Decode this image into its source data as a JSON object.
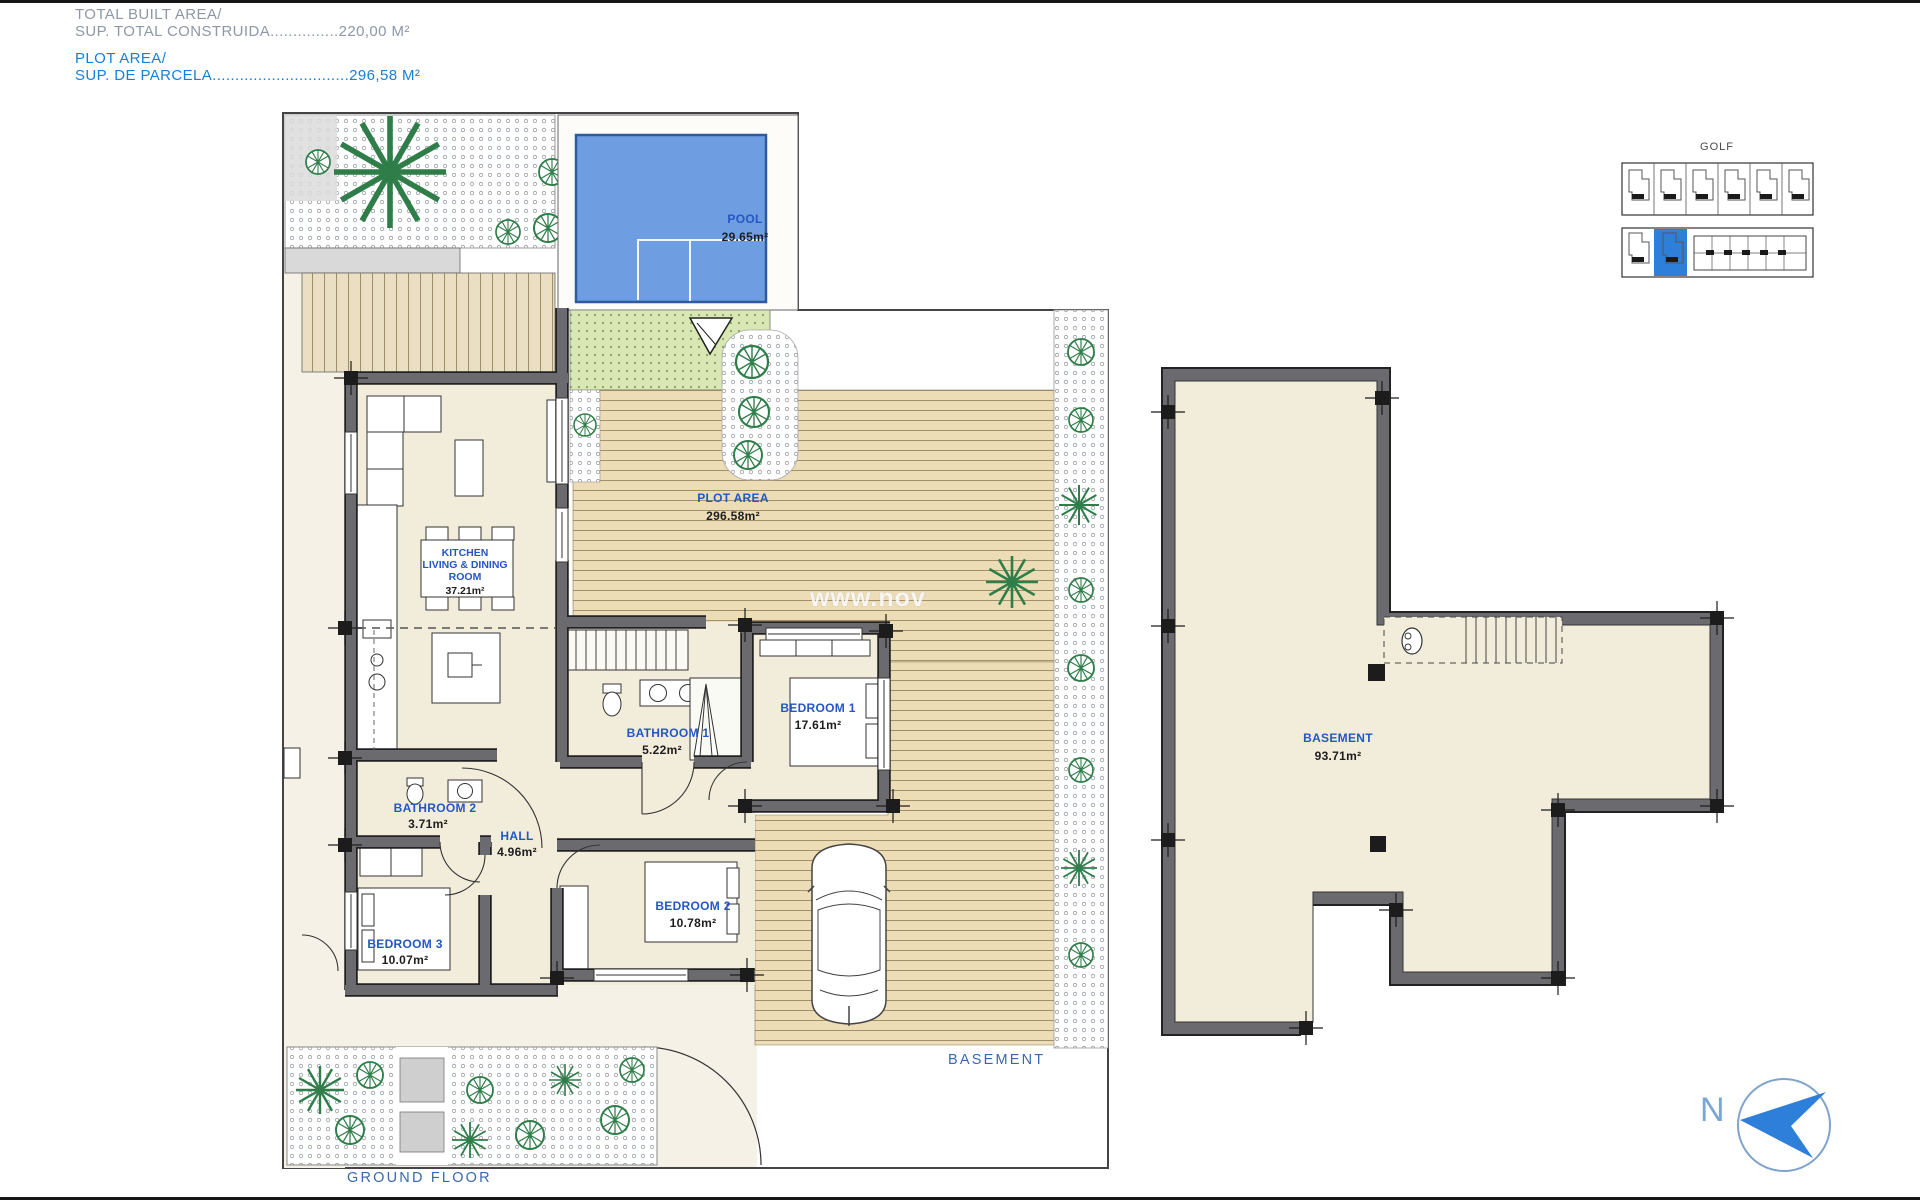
{
  "header": {
    "built_area_label": "TOTAL BUILT AREA/",
    "built_area_value": "SUP. TOTAL CONSTRUIDA...............220,00 M²",
    "plot_area_label": "PLOT AREA/",
    "plot_area_value": "SUP. DE PARCELA..............................296,58 M²"
  },
  "ground_floor": {
    "title": "GROUND FLOOR",
    "pool": {
      "name": "POOL",
      "area": "29.65m²"
    },
    "plot": {
      "name": "PLOT AREA",
      "area": "296.58m²"
    },
    "kitchen": {
      "line1": "KITCHEN",
      "line2": "LIVING & DINING",
      "line3": "ROOM",
      "area": "37.21m²"
    },
    "bathroom1": {
      "name": "BATHROOM 1",
      "area": "5.22m²"
    },
    "bedroom1": {
      "name": "BEDROOM 1",
      "area": "17.61m²"
    },
    "bathroom2": {
      "name": "BATHROOM 2",
      "area": "3.71m²"
    },
    "hall": {
      "name": "HALL",
      "area": "4.96m²"
    },
    "bedroom2": {
      "name": "BEDROOM 2",
      "area": "10.78m²"
    },
    "bedroom3": {
      "name": "BEDROOM 3",
      "area": "10.07m²"
    }
  },
  "basement": {
    "title": "BASEMENT",
    "room": {
      "name": "BASEMENT",
      "area": "93.71m²"
    }
  },
  "site_map": {
    "title": "GOLF"
  },
  "compass": {
    "north": "N"
  },
  "watermark": "www.nov",
  "colors": {
    "accent_blue": "#1680d8",
    "label_blue": "#2257c4",
    "pool_blue": "#6f9de2",
    "wall_gray": "#6b6b6f",
    "deck_beige": "#ecddb7",
    "lawn_green": "#d8e7b4",
    "highlight_unit_blue": "#2e7fd9"
  }
}
